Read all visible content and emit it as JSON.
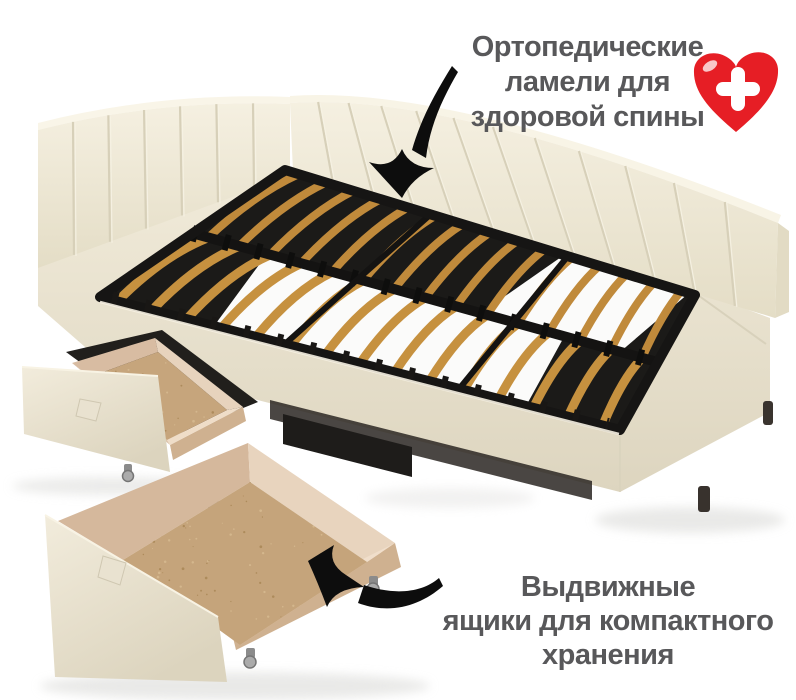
{
  "annotations": {
    "orthopedic": {
      "lines": [
        "Ортопедические",
        "ламели для",
        "здоровой спины"
      ]
    },
    "storage": {
      "lines": [
        "Выдвижные",
        "ящики для компактного",
        "хранения"
      ]
    }
  },
  "icons": {
    "heart": "heart-with-medical-cross",
    "arrow_top": "curved-arrow-pointing-to-slats",
    "arrow_bottom": "curved-arrow-pointing-to-drawer"
  },
  "colors": {
    "background": "#ffffff",
    "text": "#58585a",
    "heart_red": "#e61e25",
    "upholstery_cream": "#efe9d7",
    "slat_wood": "#c6913f",
    "frame_black": "#1b1a18",
    "drawer_wood": "#e6d2ba",
    "chipboard": "#c3a279"
  }
}
